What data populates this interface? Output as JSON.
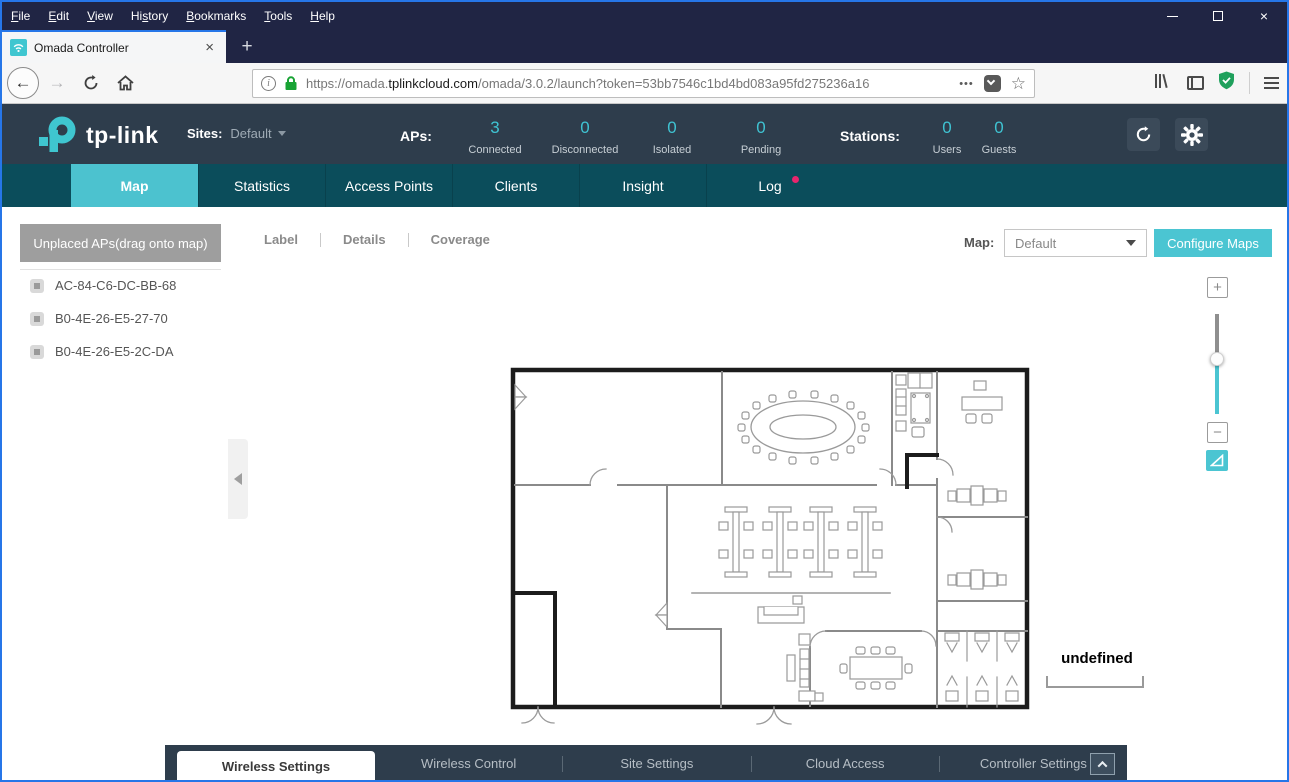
{
  "titlebar": {
    "menu": [
      {
        "pre": "",
        "accel": "F",
        "post": "ile"
      },
      {
        "pre": "",
        "accel": "E",
        "post": "dit"
      },
      {
        "pre": "",
        "accel": "V",
        "post": "iew"
      },
      {
        "pre": "Hi",
        "accel": "s",
        "post": "tory"
      },
      {
        "pre": "",
        "accel": "B",
        "post": "ookmarks"
      },
      {
        "pre": "",
        "accel": "T",
        "post": "ools"
      },
      {
        "pre": "",
        "accel": "H",
        "post": "elp"
      }
    ],
    "close_glyph": "×"
  },
  "browser": {
    "tab_title": "Omada Controller",
    "tab_close_glyph": "×",
    "new_tab_glyph": "+",
    "back_glyph": "←",
    "forward_glyph": "→",
    "info_glyph": "i",
    "url_prefix": "https://omada.",
    "url_domain": "tplinkcloud.com",
    "url_path": "/omada/3.0.2/launch?token=53bb7546c1bd4bd083a95fd275236a16",
    "dots_glyph": "•••",
    "star_glyph": "☆"
  },
  "header": {
    "logo_text": "tp-link",
    "sites_label": "Sites:",
    "site_value": "Default",
    "aps_label": "APs:",
    "ap_stats": [
      {
        "value": "3",
        "label": "Connected"
      },
      {
        "value": "0",
        "label": "Disconnected"
      },
      {
        "value": "0",
        "label": "Isolated"
      },
      {
        "value": "0",
        "label": "Pending"
      }
    ],
    "stations_label": "Stations:",
    "station_stats": [
      {
        "value": "0",
        "label": "Users"
      },
      {
        "value": "0",
        "label": "Guests"
      }
    ]
  },
  "nav": {
    "tabs": [
      {
        "label": "Map"
      },
      {
        "label": "Statistics"
      },
      {
        "label": "Access Points"
      },
      {
        "label": "Clients"
      },
      {
        "label": "Insight"
      },
      {
        "label": "Log"
      }
    ]
  },
  "map_page": {
    "unplaced_button": "Unplaced APs(drag onto map)",
    "aps": [
      "AC-84-C6-DC-BB-68",
      "B0-4E-26-E5-27-70",
      "B0-4E-26-E5-2C-DA"
    ],
    "view_options": [
      "Label",
      "Details",
      "Coverage"
    ],
    "map_label": "Map:",
    "map_value": "Default",
    "configure_button": "Configure Maps",
    "zoom_in_glyph": "+",
    "zoom_out_glyph": "−",
    "scale_label": "undefined"
  },
  "bottom_bar": {
    "tabs": [
      {
        "label": "Wireless Settings"
      },
      {
        "label": "Wireless Control"
      },
      {
        "label": "Site Settings"
      },
      {
        "label": "Cloud Access"
      },
      {
        "label": "Controller Settings"
      }
    ]
  },
  "colors": {
    "accent_teal": "#4bc5d2",
    "active_tab_teal": "#4cc2cf",
    "nav_dark_teal": "#0b4d5b",
    "header_dark": "#2e3d4c",
    "titlebar_navy": "#202544",
    "window_border_blue": "#2676e8",
    "log_badge_pink": "#e8256d",
    "lock_green": "#18a334",
    "stat_number_teal": "#3fc3d2"
  }
}
